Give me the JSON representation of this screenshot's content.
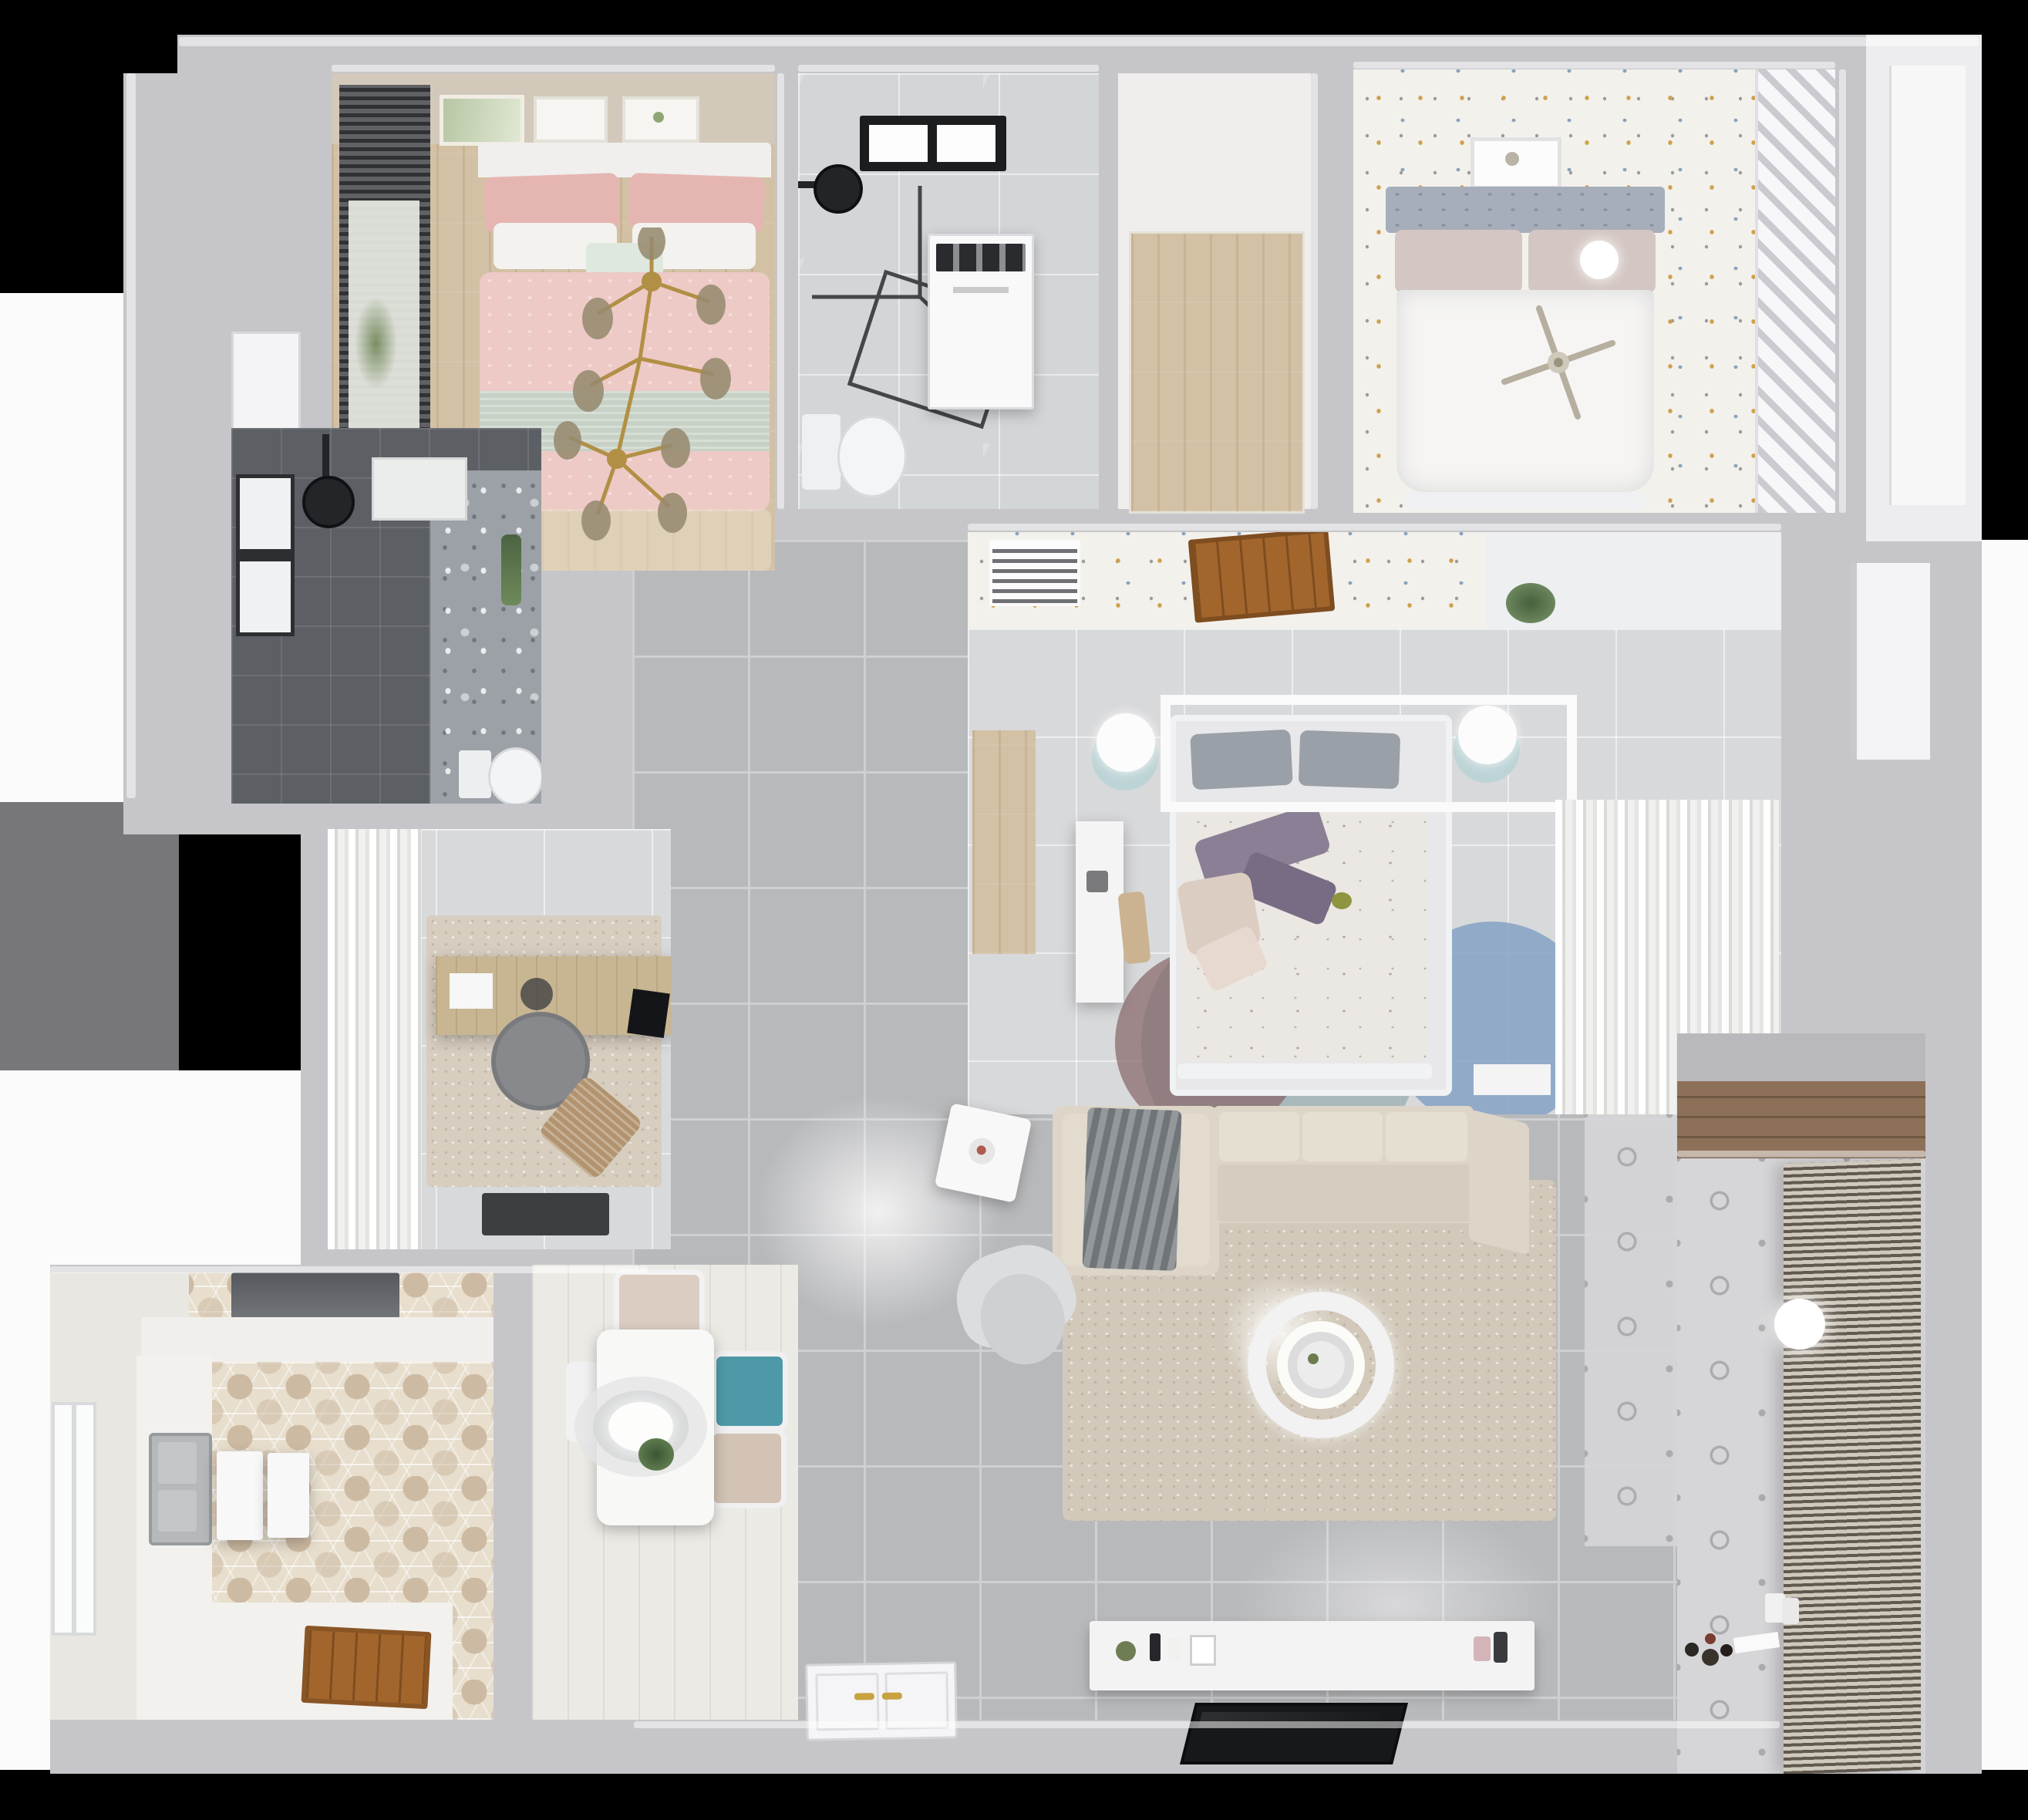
{
  "scene": {
    "title": "Top-down 3D render of an apartment floor plan",
    "type": "3d-floorplan-render",
    "view": "top-down",
    "visible_text": []
  },
  "palette": {
    "bg": "#000000",
    "outsideWhite": "#fbfbfc",
    "outsideGray": "#77777b",
    "wall": "#c6c6ca",
    "wallLight": "#e9e9eb",
    "tile": "#b8b9bb",
    "tileLine": "#ced0d2",
    "paleTile": "#d8d9db",
    "marble": "#d3d6d8",
    "woodFloor": "#d3c1a5",
    "plankWhite": "#eceae5",
    "hexA": "#e7decd",
    "hexB": "#cdbaa2",
    "speckBase": "#f3f1ec",
    "speckGold": "#cfa14e",
    "speckBlue": "#8aa2ba",
    "speckGray": "#9a9a9a",
    "darkTile": "#5c5f64",
    "motifBase": "#d6d6d8",
    "motifLine": "#ababaf",
    "pink": "#edcac6",
    "pinkDeep": "#e5b5b2",
    "sage": "#c7d1c6",
    "white": "#f5f5f6",
    "gold": "#b18f45",
    "glass": "#9c9076",
    "blindDark": "#4a4b4f",
    "teal": "#4e99a8",
    "tealSoft": "#bdd4d6",
    "steel": "#b6b9bc",
    "sofa": "#dcd5c8",
    "sofaSeat": "#d5cec0",
    "rugLiving": "#d2c9ba",
    "blanket": "#70757a",
    "rugTeal": "#9fb1b3",
    "rugBlue": "#7f9ec2",
    "rugMaroon": "#8a6b6e",
    "purple": "#8b7f95",
    "beigePillow": "#dccdc2",
    "headboardGuest": "#a6aebb",
    "duvet": "#ebe7e2",
    "bedWhite": "#f6f5f3",
    "doorWood": "#a2652c",
    "nicheWood": "#8c7158",
    "blinds": "#93897c",
    "hood": "#696c70",
    "tv": "#17181a",
    "mat": "#3c3e41",
    "grayChair": "#87898c",
    "loungeWood": "#b1946f",
    "deskWood": "#c8b692"
  },
  "rooms": [
    {
      "id": "bedroom-pink",
      "name": "Bedroom with pink bedding (top left)",
      "floor": "light wood",
      "furniture": [
        "double bed with pink duvet and sage throw",
        "pink and white pillows",
        "gold branch chandelier",
        "dark roman blind window",
        "three wall art frames"
      ]
    },
    {
      "id": "bathroom-top",
      "name": "Bathroom (top middle)",
      "floor": "gray marble tile",
      "furniture": [
        "black framed skylight",
        "black shower head",
        "glass shower enclosure",
        "white washing machine",
        "toilet"
      ]
    },
    {
      "id": "closet-wood",
      "name": "Walk-in closet with wood floor (top middle right)",
      "floor": "wood planks",
      "furniture": []
    },
    {
      "id": "bedroom-guest",
      "name": "Guest bedroom (top right)",
      "floor": "white floor with confetti speckles",
      "furniture": [
        "bed with gray-blue headboard and white duvet",
        "white sphere lamp",
        "ceiling fan",
        "wall art frame",
        "slatted shelving wall"
      ]
    },
    {
      "id": "corridor",
      "name": "Corridor with speckled wallpaper floor",
      "floor": "speckled",
      "furniture": [
        "white AC vent grille",
        "open wood door",
        "potted plant"
      ]
    },
    {
      "id": "bedroom-master",
      "name": "Master bedroom (center right)",
      "floor": "pale tile",
      "furniture": [
        "bed with floral duvet and purple pillows",
        "white canopy frame and book shelf",
        "two nightstand lamps with teal bases",
        "white desk",
        "wood closet nook",
        "round rug of teal, blue and maroon circles",
        "sheer curtain wardrobe"
      ]
    },
    {
      "id": "bathroom-dark",
      "name": "Dark tiled bathroom (middle left)",
      "floor": "dark gray tile",
      "furniture": [
        "window",
        "black shower head",
        "white wall cabinet",
        "floral accent wall",
        "toilet",
        "plant"
      ]
    },
    {
      "id": "study",
      "name": "Study (middle left)",
      "floor": "pale tile with rug",
      "furniture": [
        "white drape curtain wall",
        "wood desk with monitor",
        "gray round chair",
        "wood lounge chair",
        "dark door mat"
      ]
    },
    {
      "id": "kitchen",
      "name": "Kitchen (bottom left)",
      "floor": "hexagon tile",
      "furniture": [
        "range hood",
        "white counters",
        "stainless double sink",
        "two white trays",
        "window",
        "wood door threshold"
      ]
    },
    {
      "id": "dining",
      "name": "Dining nook",
      "floor": "whitewashed planks",
      "furniture": [
        "white table",
        "oval ceiling lamp",
        "plant centerpiece",
        "two beige chairs",
        "teal chair",
        "white chair"
      ]
    },
    {
      "id": "living",
      "name": "Living room (center bottom)",
      "floor": "gray tile",
      "furniture": [
        "L-shaped beige sectional sofa",
        "gray throw blanket",
        "beige rug",
        "round ceiling light",
        "gray armchair",
        "white side table",
        "white TV console with decor",
        "flat black TV panel"
      ]
    },
    {
      "id": "balcony",
      "name": "Balcony / laundry (bottom right)",
      "floor": "patterned tile",
      "furniture": [
        "full-height blinds",
        "round ceiling light",
        "toy car and toys",
        "wood storage niche"
      ]
    },
    {
      "id": "entry",
      "name": "Entry",
      "floor": "tile",
      "furniture": [
        "white paneled front door with gold handles"
      ]
    }
  ]
}
